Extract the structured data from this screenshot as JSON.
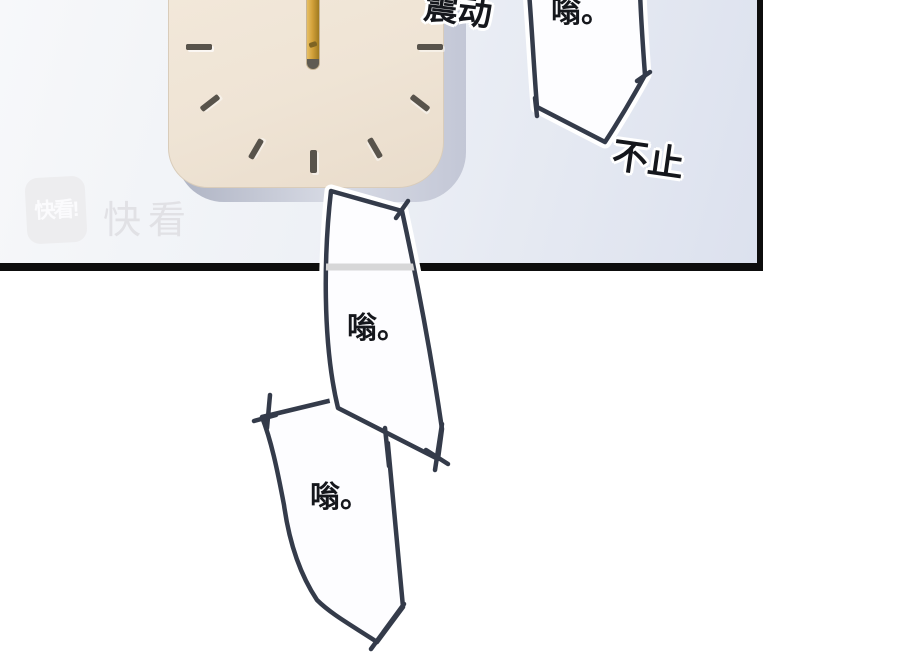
{
  "watermark": {
    "badge_label": "快看!",
    "brand_label": "快看"
  },
  "sfx": {
    "vibrate": "震动",
    "buzz_top": "嗡。",
    "nonstop": "不止",
    "buzz_mid": "嗡。",
    "buzz_bottom": "嗡。"
  },
  "colors": {
    "ink": "#0d0d0d",
    "stroke": "#343b4a",
    "panel_left": "#f7f8fa",
    "panel_right": "#dce1ee",
    "clock_face": "#efe4d5",
    "clock_depth": "#c3c8d6",
    "hand_gold": "#d2a13a",
    "tick": "#58534b",
    "watermark_gray": "#e1e1e5"
  }
}
